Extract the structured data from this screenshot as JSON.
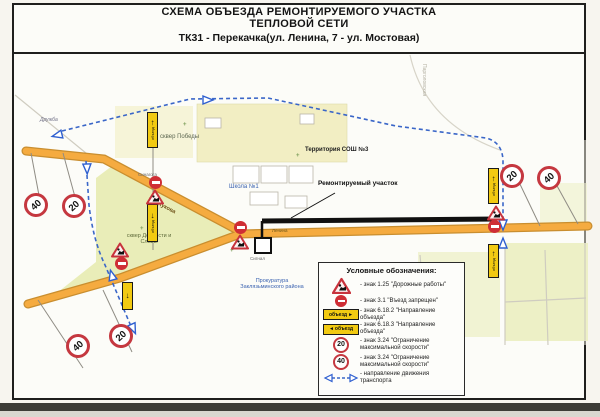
{
  "title": {
    "line1": "СХЕМА ОБЪЕЗДА РЕМОНТИРУЕМОГО УЧАСТКА",
    "line2": "ТЕПЛОВОЙ СЕТИ",
    "line3": "ТК31 - Перекачка(ул. Ленина, 7 - ул. Мостовая)"
  },
  "map": {
    "labels": {
      "park_pobedy": "сквер Победы",
      "school_territory": "Территория СОШ №3",
      "school1": "Школа №1",
      "repair_section": "Ремонтируемый участок",
      "park_doblesti": "сквер Доблести и Славы",
      "sinagoga": "Синагога",
      "signal": "Сигнал",
      "prosecutor": "Прокуратура Заклязьминского района",
      "street_zhukova": "ул. Жукова",
      "street_lenina": "Ленина",
      "druzhba": "Дружба",
      "pargolovskaya": "Парголовская"
    },
    "signs": {
      "speed20": "20",
      "speed40": "40",
      "detour": "объезд"
    }
  },
  "icons": {
    "arrow_up": "↑",
    "arrow_down": "↓",
    "arrow_left": "◄",
    "arrow_right": "►",
    "tree": "+"
  },
  "legend": {
    "title": "Условные обозначения:",
    "items": [
      {
        "icon": "roadworks-sign",
        "label": "- знак 1.25 \"Дорожные работы\""
      },
      {
        "icon": "no-entry-sign",
        "label": "- знак 3.1 \"Въезд запрещен\""
      },
      {
        "icon": "detour-right-sign",
        "label": "- знак 6.18.2 \"Направление объезда\""
      },
      {
        "icon": "detour-left-sign",
        "label": "- знак 6.18.3 \"Направление объезда\""
      },
      {
        "icon": "speed-20-sign",
        "label": "- знак 3.24 \"Ограничение максимальной скорости\""
      },
      {
        "icon": "speed-40-sign",
        "label": "- знак 3.24 \"Ограничение максимальной скорости\""
      },
      {
        "icon": "traffic-direction-arrow",
        "label": "- направление движения транспорта"
      }
    ]
  }
}
